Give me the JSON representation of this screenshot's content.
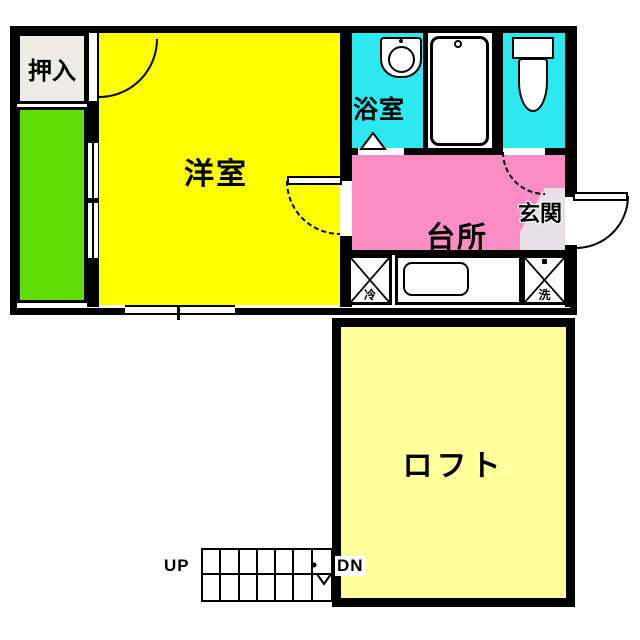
{
  "plan": {
    "upper": {
      "closet_label": "押入",
      "western_room_label": "洋室",
      "bathroom_label": "浴室",
      "kitchen_label": "台所",
      "entry_label": "玄関",
      "fridge_label": "冷",
      "washer_label": "洗"
    },
    "lower": {
      "loft_label": "ロフト",
      "stairs_up_label": "UP",
      "stairs_down_label": "DN"
    }
  },
  "colors": {
    "wall_black": "#000000",
    "room_yellow": "#FFFF00",
    "loft_yellow": "#FFFF9C",
    "veranda_green": "#5FDE06",
    "wet_cyan": "#2BE9EE",
    "kitchen_pink": "#FB8DC5",
    "entry_gray": "#E7E1E7",
    "closet_gray": "#EDEDE6"
  }
}
